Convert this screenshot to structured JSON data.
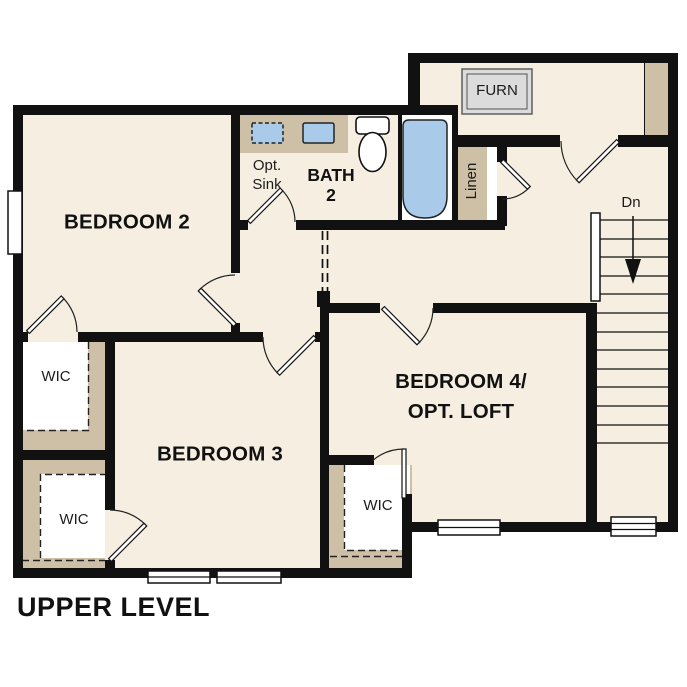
{
  "title": "UPPER LEVEL",
  "palette": {
    "floor": "#f5eee1",
    "closet_tan": "#cdc0a6",
    "fixture_blue": "#a9cbe9",
    "wall": "#111111",
    "furnace_gray": "#dcdcdc",
    "text": "#111111"
  },
  "rooms": {
    "bedroom2": {
      "label": "BEDROOM 2"
    },
    "bedroom3": {
      "label": "BEDROOM 3"
    },
    "bedroom4": {
      "line1": "BEDROOM 4/",
      "line2": "OPT. LOFT"
    },
    "bath2": {
      "line1": "BATH",
      "line2": "2"
    },
    "opt_sink": {
      "line1": "Opt.",
      "line2": "Sink"
    },
    "linen": {
      "label": "Linen"
    },
    "furnace": {
      "label": "FURN"
    },
    "stairs": {
      "label": "Dn"
    },
    "wic_bedroom2": {
      "label": "WIC"
    },
    "wic_bedroom3": {
      "label": "WIC"
    },
    "wic_bedroom4": {
      "label": "WIC"
    }
  }
}
